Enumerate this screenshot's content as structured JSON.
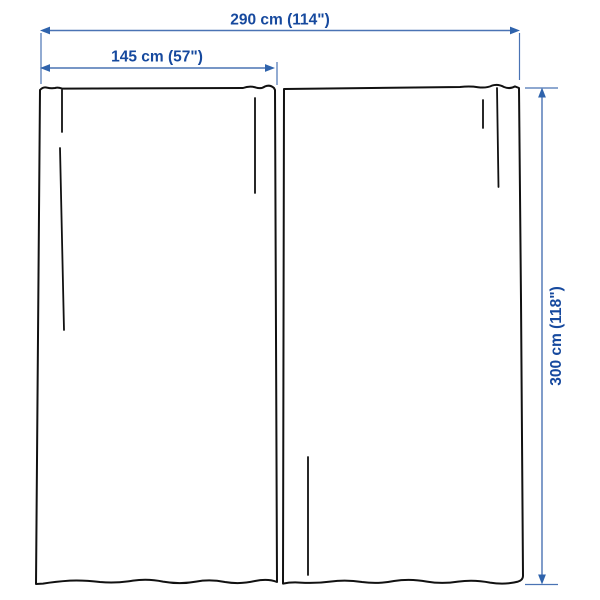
{
  "diagram": {
    "kind": "curtain-pair-measurement-diagram"
  },
  "dimensions": {
    "total_width": {
      "label": "290 cm (114\")"
    },
    "panel_width": {
      "label": "145 cm (57\")"
    },
    "height": {
      "label": "300 cm (118\")"
    }
  },
  "colors": {
    "background": "#ffffff",
    "outline": "#111111",
    "dimension_line": "#4a73b4",
    "dimension_arrow": "#2f63ac",
    "dimension_text": "#16499e"
  }
}
